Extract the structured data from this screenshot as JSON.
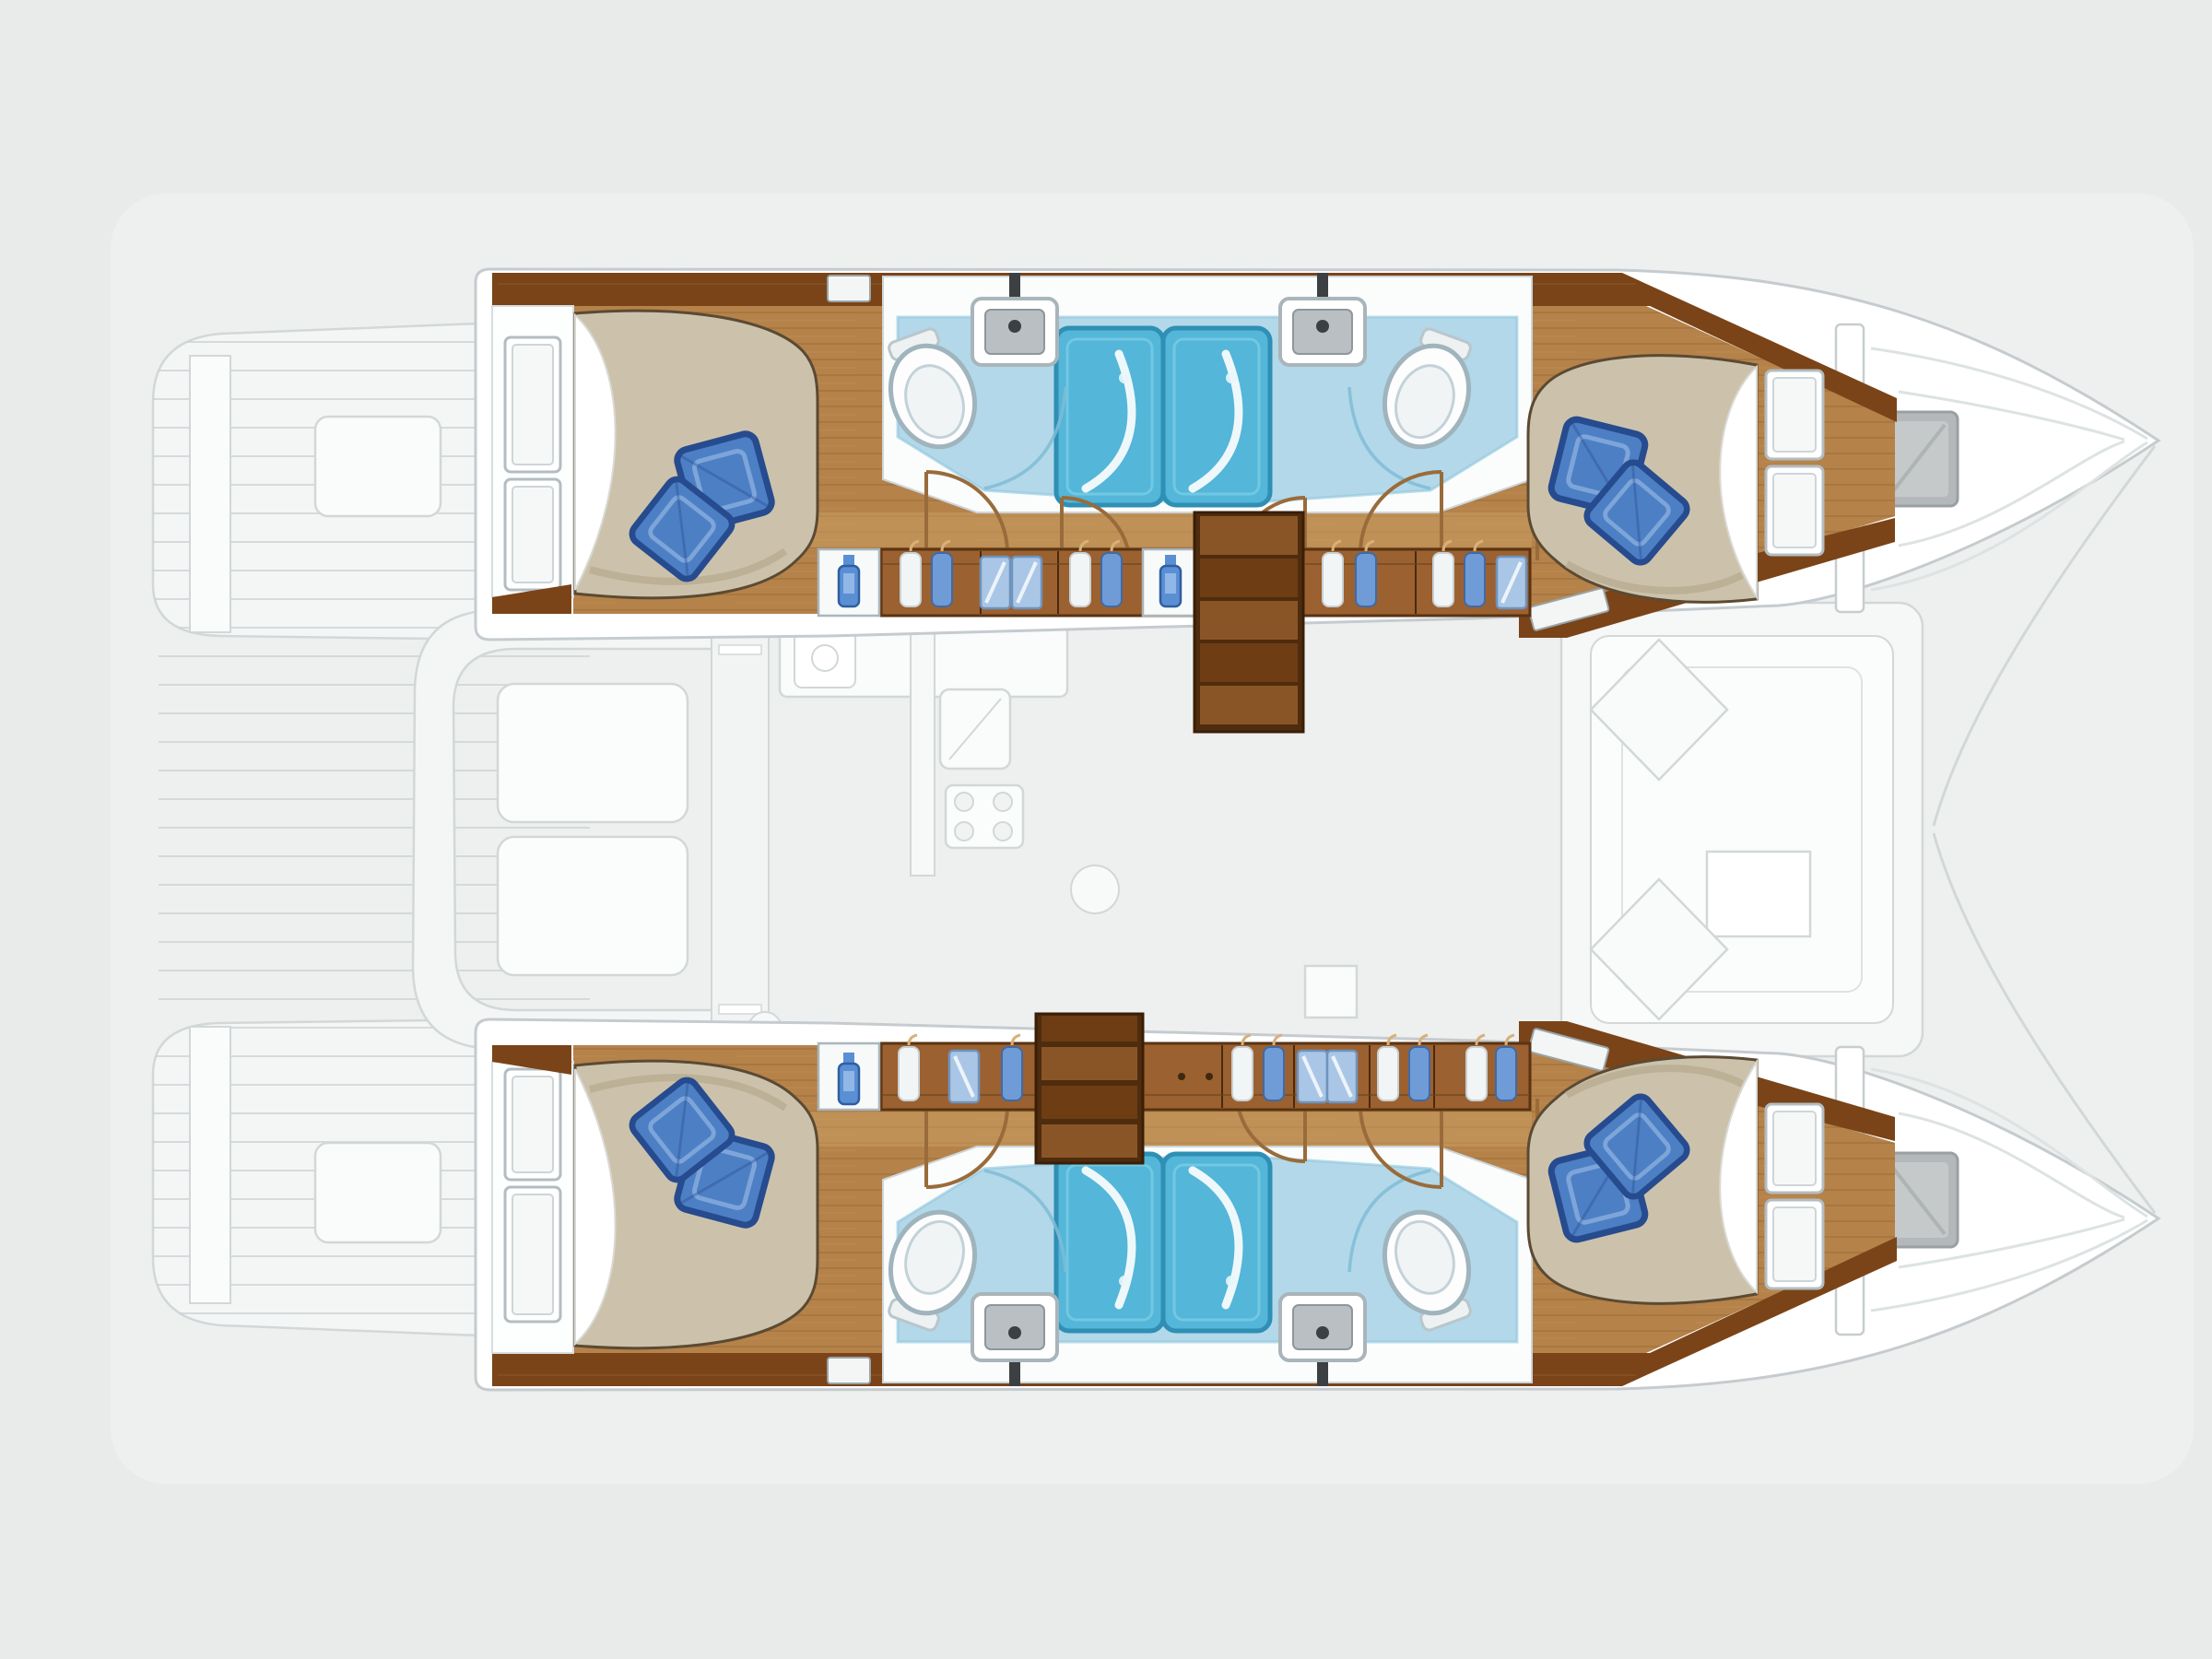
{
  "document": {
    "kind": "yacht floor plan",
    "view": "overhead lower-deck layout",
    "vessel_type": "sailing catamaran",
    "bow_direction": "right",
    "upper_deck_style": "ghosted light gray"
  },
  "palette": {
    "background": "#e9ebeb",
    "boat_glow": "#f3f5f4",
    "hull_white": "#ffffff",
    "hull_outline": "#c5cbce",
    "ghost_stroke": "#d2d7d8",
    "ghost_fill": "#f4f6f6",
    "ghost_bright": "#fbfcfc",
    "wood": "#b5824a",
    "wood_light": "#cfa468",
    "wood_trim": "#7a4418",
    "wood_cabinet": "#9c6130",
    "steps_a": "#8a5526",
    "steps_b": "#6e3d14",
    "duvet": "#ccc2ab",
    "sheet": "#ffffff",
    "pillow": "#4d7fc4",
    "pillow_dark": "#274b8f",
    "pillow_light": "#86abdd",
    "bath_floor": "#b2d8e9",
    "shower": "#54b6d8",
    "shower_dark": "#2f8fb5",
    "fixture_white": "#fdfdfd",
    "fixture_stroke": "#9fb4bd",
    "sink_basin": "#b9bfc2",
    "hatch_gray": "#b4b8ba",
    "glass_blue": "#a9c6e6",
    "clothes_white": "#f2f5f6",
    "clothes_blue": "#6f9bd6",
    "door_arc": "#9a6b3a"
  },
  "hulls": [
    {
      "id": "port-hull",
      "position": "top",
      "rooms": [
        {
          "name": "aft cabin",
          "features": [
            "double bed",
            "2 blue pillows",
            "2 hull windows",
            "white sheet at head"
          ]
        },
        {
          "name": "aft bathroom",
          "features": [
            "toilet",
            "washbasin with faucet",
            "shower stall"
          ]
        },
        {
          "name": "companionway corridor",
          "features": [
            "wardrobes with hanging clothes",
            "glass-front lockers",
            "2 white locker cabinets with blue bottle",
            "steps up to saloon"
          ]
        },
        {
          "name": "forward bathroom",
          "features": [
            "toilet",
            "washbasin with faucet",
            "shower stall"
          ]
        },
        {
          "name": "forward cabin",
          "features": [
            "double bed",
            "2 blue pillows",
            "2 headboard panels",
            "white sheet at head"
          ]
        },
        {
          "name": "bow locker",
          "features": [
            "gray deck hatch",
            "anchor locker lines"
          ]
        }
      ]
    },
    {
      "id": "starboard-hull",
      "position": "bottom",
      "rooms": [
        {
          "name": "aft cabin",
          "features": [
            "double bed",
            "2 blue pillows",
            "2 hull windows",
            "white sheet at head"
          ]
        },
        {
          "name": "aft bathroom",
          "features": [
            "toilet",
            "washbasin with faucet",
            "shower stall"
          ]
        },
        {
          "name": "companionway corridor",
          "features": [
            "wardrobes with hanging clothes",
            "glass-front lockers",
            "white locker cabinet with blue bottle",
            "steps up to saloon"
          ]
        },
        {
          "name": "forward bathroom",
          "features": [
            "toilet",
            "washbasin with faucet",
            "shower stall"
          ]
        },
        {
          "name": "forward cabin",
          "features": [
            "double bed",
            "2 blue pillows",
            "2 headboard panels",
            "white sheet at head"
          ]
        },
        {
          "name": "bow locker",
          "features": [
            "gray deck hatch",
            "anchor locker lines"
          ]
        }
      ]
    }
  ],
  "bridge_deck_ghost": {
    "areas": [
      "port stern platform with planking",
      "starboard stern platform with planking",
      "cockpit C-bench",
      "two cockpit tables",
      "sliding-door walkway",
      "galley counter with sink",
      "refrigerator",
      "stove with 4 burners",
      "saloon sofa ring",
      "navigation desk",
      "mast step square",
      "2 foredeck hatches",
      "bow bridle lines",
      "deck planking"
    ]
  },
  "totals": {
    "cabins": 4,
    "bathrooms": 4,
    "showers": 4,
    "toilets": 4,
    "washbasins": 4,
    "double_beds": 4,
    "pillows": 8,
    "stair_flights": 2
  }
}
